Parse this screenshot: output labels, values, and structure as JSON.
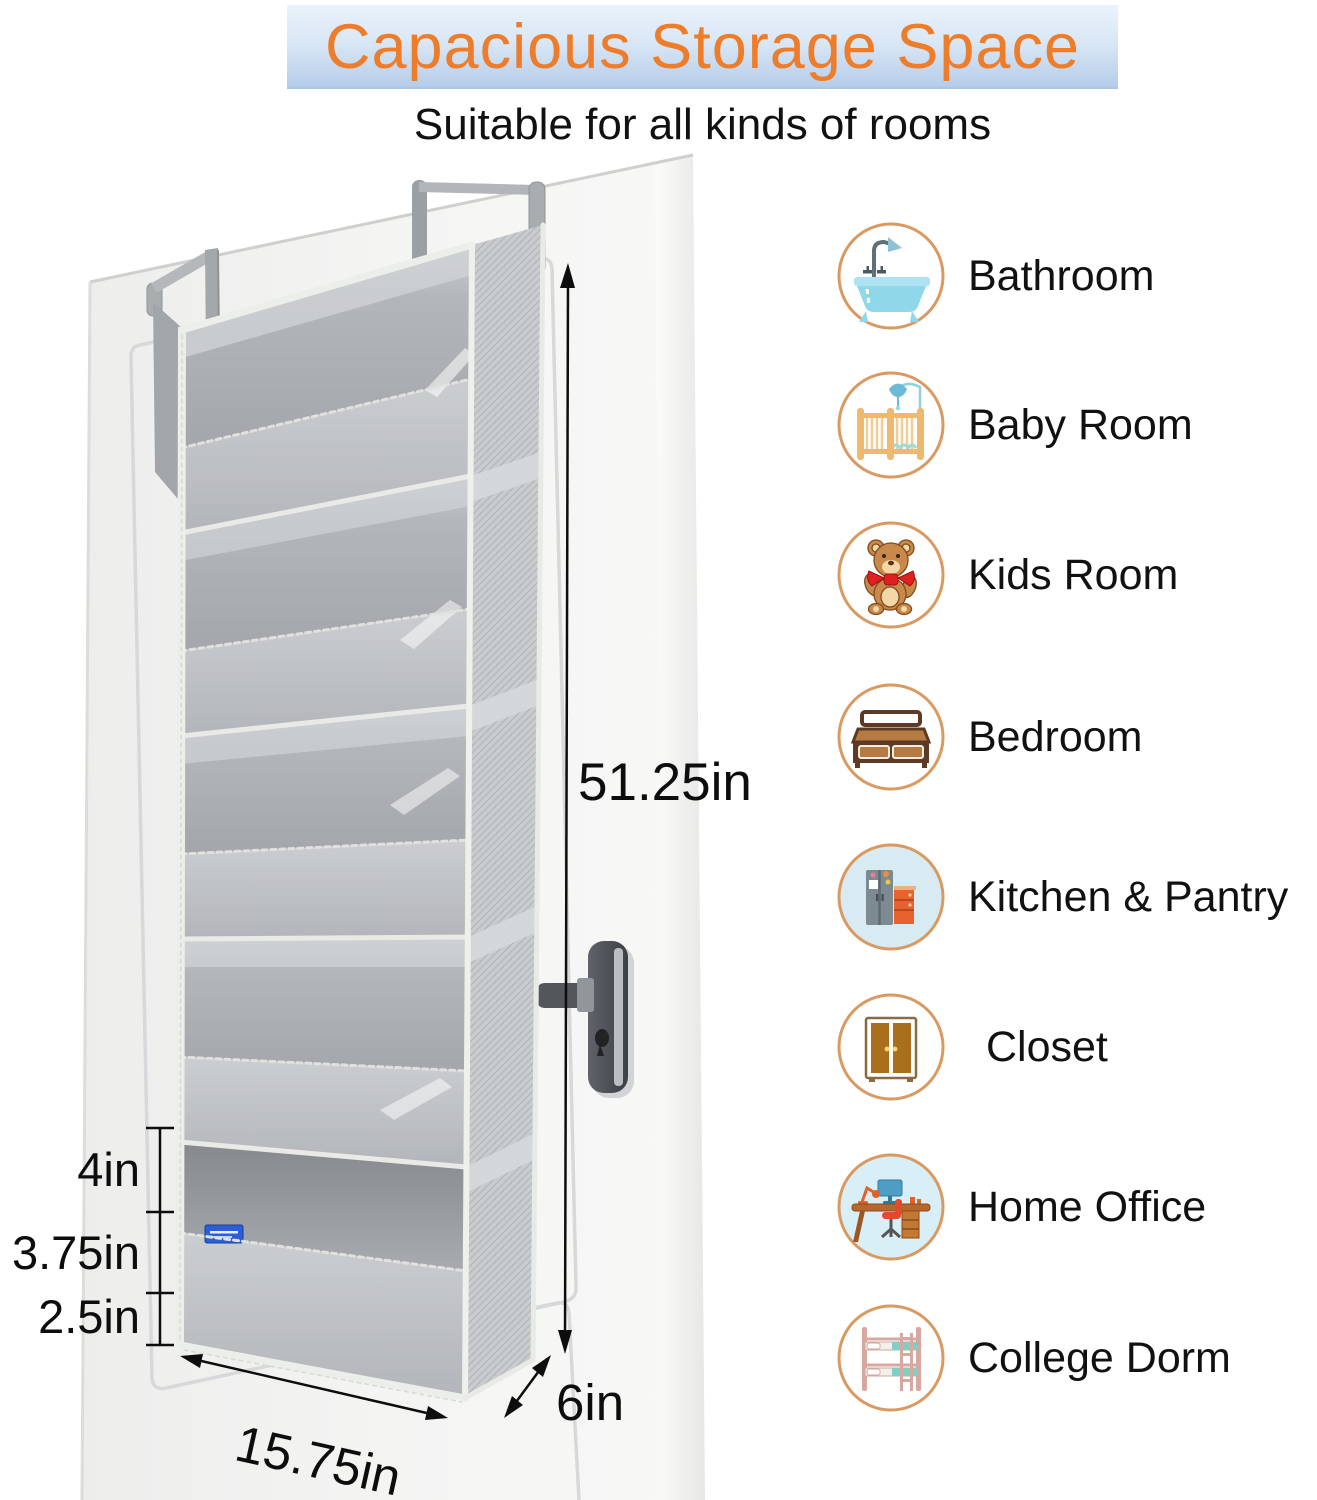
{
  "banner": {
    "title": "Capacious Storage Space"
  },
  "subtitle": "Suitable for all kinds of rooms",
  "dimensions": {
    "height": "51.25in",
    "width": "15.75in",
    "depth": "6in",
    "pocket_top": "4in",
    "pocket_middle": "3.75in",
    "pocket_bottom": "2.5in"
  },
  "rooms": [
    {
      "label": "Bathroom",
      "icon": "bathtub-icon"
    },
    {
      "label": "Baby Room",
      "icon": "crib-icon"
    },
    {
      "label": "Kids Room",
      "icon": "teddy-bear-icon"
    },
    {
      "label": "Bedroom",
      "icon": "bed-icon"
    },
    {
      "label": "Kitchen & Pantry",
      "icon": "fridge-icon"
    },
    {
      "label": "Closet",
      "icon": "wardrobe-icon"
    },
    {
      "label": "Home Office",
      "icon": "desk-icon"
    },
    {
      "label": "College Dorm",
      "icon": "bunk-bed-icon"
    }
  ],
  "colors": {
    "accent_orange": "#ED7D2A",
    "banner_blue_top": "#EAF2FB",
    "banner_blue_bottom": "#A9C2E0",
    "icon_ring": "#D99A62",
    "organizer_gray": "#BCC0C3",
    "dimension_black": "#0D0D0D"
  }
}
